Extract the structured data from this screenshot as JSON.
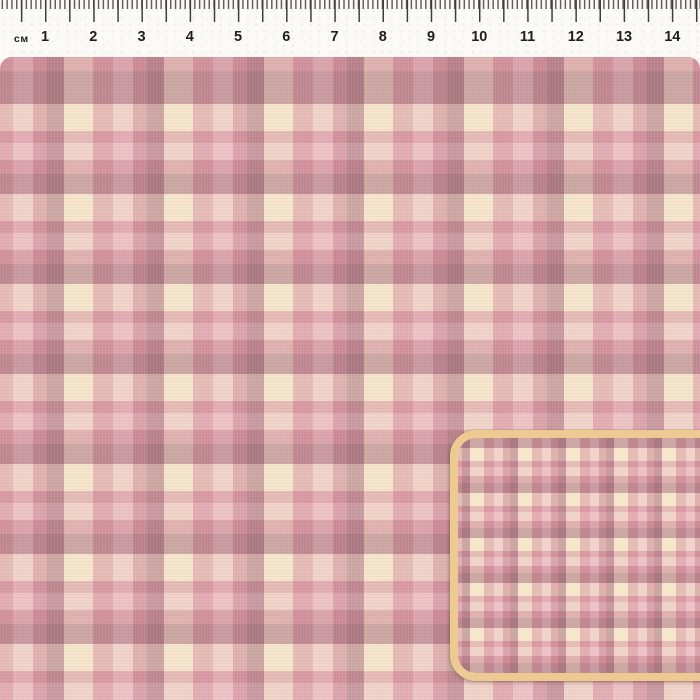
{
  "ruler": {
    "unit_label": "см",
    "numbers": [
      "1",
      "2",
      "3",
      "4",
      "5",
      "6",
      "7",
      "8",
      "9",
      "10",
      "11",
      "12",
      "13",
      "14"
    ]
  },
  "palette": {
    "paper": "#fbfaf6",
    "tick": "#3c3c3c",
    "num": "#1e1e1e",
    "dark": "#d0b0b6",
    "cream": "#faf2e4",
    "med": "#ebc6cc",
    "light": "#f6dfe1",
    "deep": "#e4bcc4",
    "tan": "#eeca93"
  },
  "fabric_pattern": {
    "type": "plaid",
    "blend": "multiply",
    "column_repeat_cm": 2,
    "row_repeat_cm": 2,
    "stripe_sequence": [
      "dark-mauve",
      "cream",
      "medium-pink",
      "light-pink",
      "deep-pink"
    ],
    "rendered_colors": {
      "dark_intersection": "#aa7a82",
      "cream_intersection": "#f5e8d4",
      "pink_intersection": "#d89aa3",
      "light_pink_intersection": "#edc3c6",
      "dark_cream_intersection": "#cba7a4"
    }
  },
  "inset": {
    "description": "half-scale swatch preview",
    "border_color": "#eeca93"
  }
}
